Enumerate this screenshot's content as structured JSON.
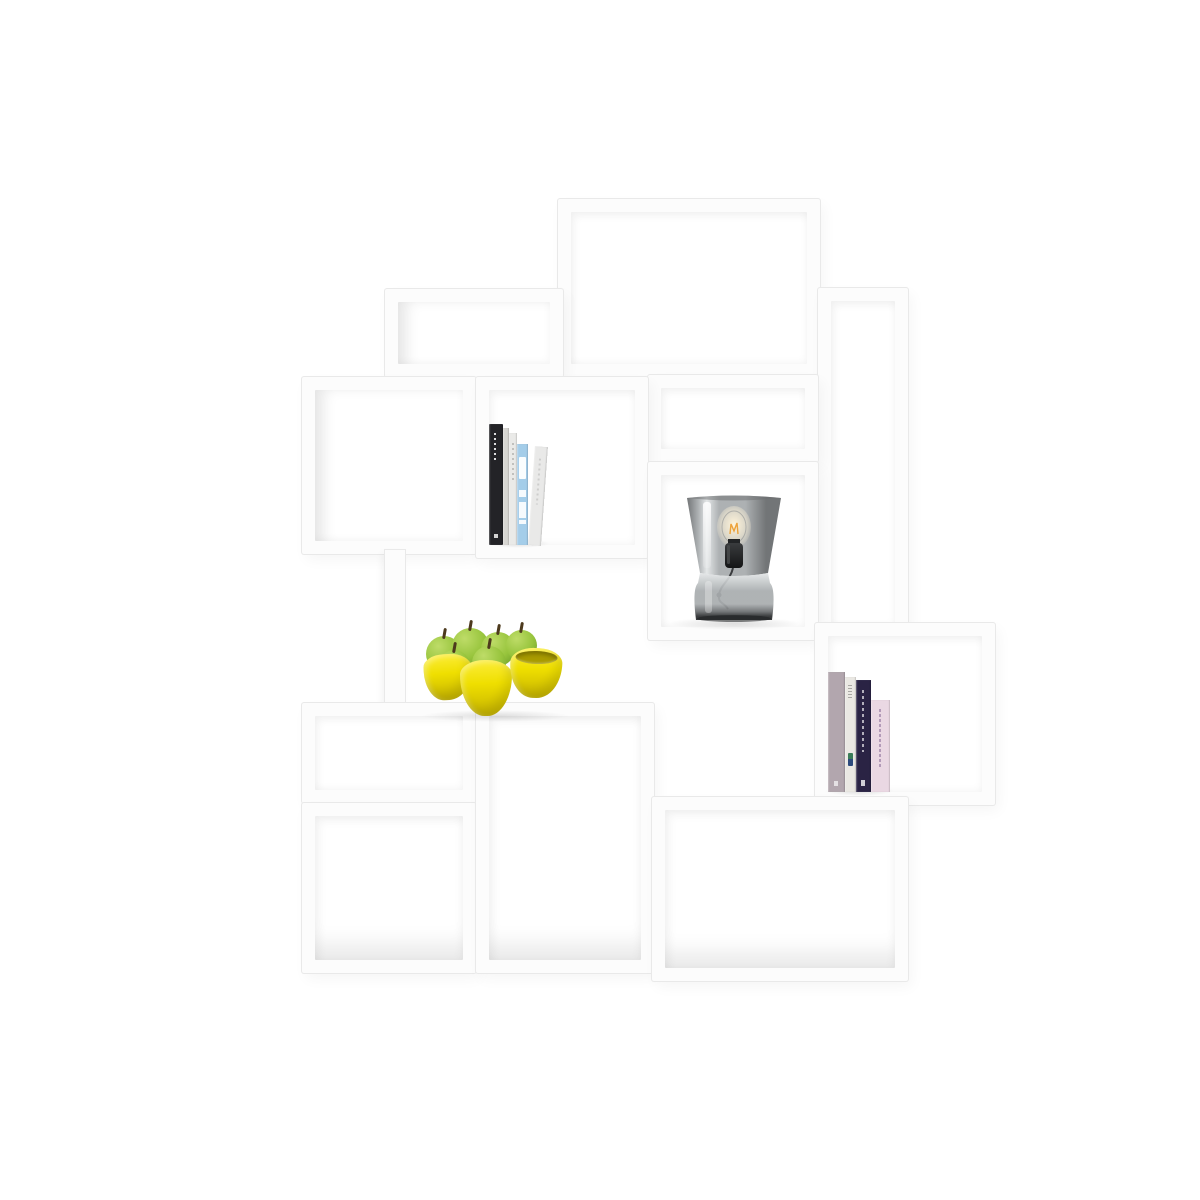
{
  "scene": {
    "type": "product-photo",
    "subject": "White modular stacked cube shelving unit on a white background, decorated with books, a smoked-glass table lamp and a yellow lobed bowl of green apples"
  },
  "shelf": {
    "module_count": 13,
    "modules": [
      "top-large",
      "upper-left-half",
      "right-tall",
      "middle-left",
      "middle-books-cell",
      "middle-right-half",
      "lamp-cell",
      "right-books-cell",
      "support-panel",
      "lower-left-half",
      "bottom-left",
      "bottom-middle",
      "bottom-right"
    ]
  },
  "objects": {
    "left_books": {
      "label": "five books standing upright, black, white and light-blue spines",
      "count": 5
    },
    "lamp": {
      "label": "grey smoked-glass table lamp with exposed filament bulb and black socket"
    },
    "fruit_bowl": {
      "label": "bright yellow three-lobed bowl holding green apples",
      "apple_count": 6
    },
    "right_books": {
      "label": "four books standing upright, mauve, white, dark-purple and pale-pink spines",
      "count": 4
    }
  },
  "css_vars": {
    "bg": "#ffffff",
    "shelf-face": "#fcfcfc",
    "shelf-line": "#e9e9e9",
    "book-l1": "#232327",
    "book-l2": "#d7d6d2",
    "book-l3": "#eaeae8",
    "book-l4": "#a4cde9",
    "book-l5": "#e9e9e8",
    "book-r1": "#b2a6ae",
    "book-r2": "#eae8e3",
    "book-r3": "#2a2344",
    "book-r4": "#ead8e3",
    "lamp-glass-hi": "#e3e6e7",
    "lamp-glass": "#a9adaf",
    "lamp-glass-dark": "#6b6e70",
    "lamp-base-dark": "#2c2e30",
    "lamp-socket": "#141516",
    "lamp-filament": "#eda23a",
    "lamp-bulb-glow": "#fff4da",
    "bowl-light": "#fbec35",
    "bowl": "#efdf00",
    "bowl-dark": "#c6b400",
    "bowl-rim": "#a99b00",
    "apple-light": "#bedc68",
    "apple": "#97c43c",
    "apple-dark": "#6d9d28",
    "stem": "#4d3a1d"
  }
}
